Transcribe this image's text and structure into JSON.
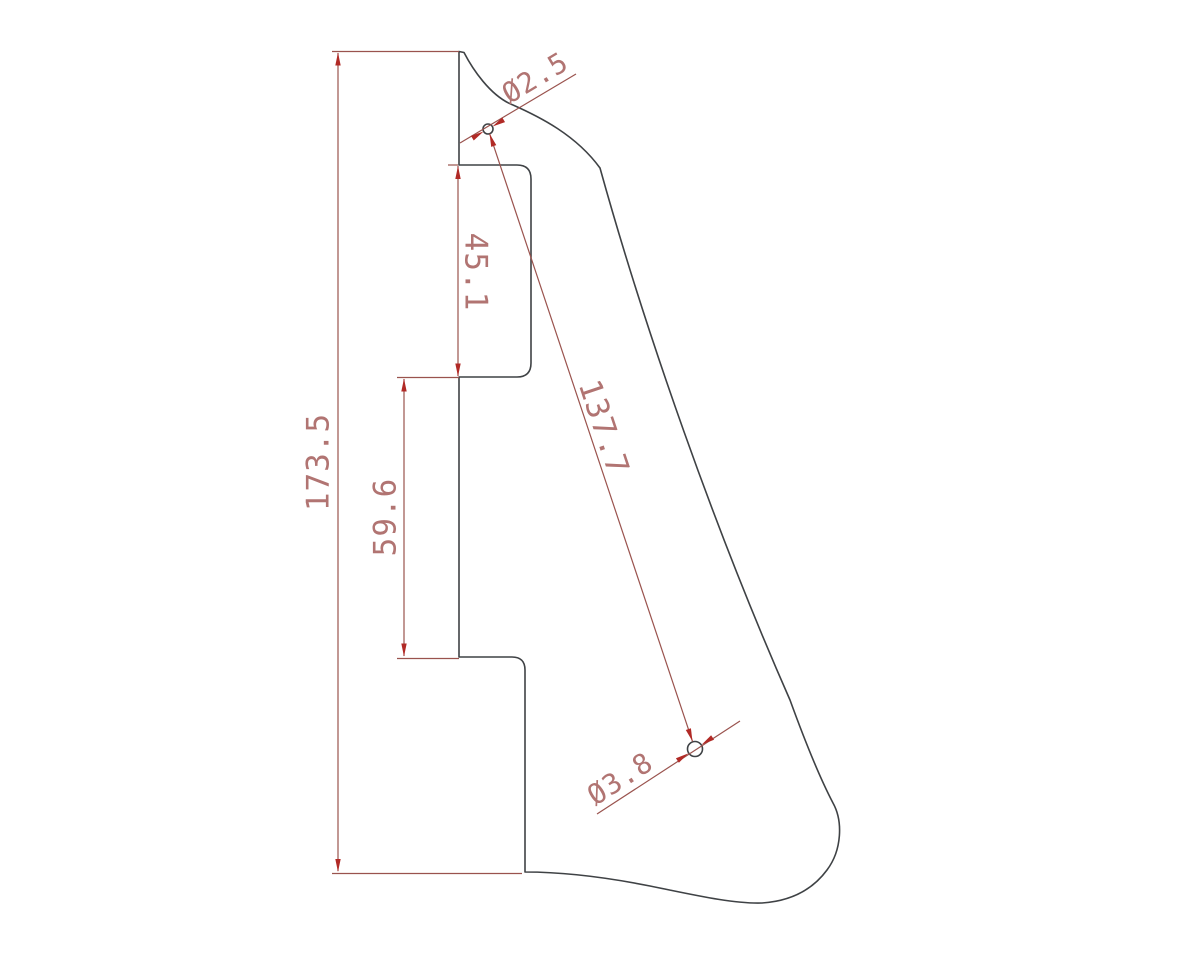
{
  "drawing": {
    "type": "2D CAD technical drawing of a pickguard-like outline with dimensions",
    "units_precision": "one decimal place",
    "dimensions": {
      "overall_height": "173.5",
      "notch_height": "45.1",
      "mid_section_height": "59.6",
      "hole_spacing": "137.7",
      "small_hole_diameter": "Ø2.5",
      "large_hole_diameter": "Ø3.8"
    },
    "holes": [
      {
        "name": "top-hole",
        "diameter_label": "Ø2.5"
      },
      {
        "name": "bottom-hole",
        "diameter_label": "Ø3.8"
      }
    ]
  },
  "colors": {
    "background": "#ffffff",
    "outline": "#3f4245",
    "dimension_line": "#9a534e",
    "arrowhead": "#b12a26",
    "dimension_text": "#b17472"
  }
}
